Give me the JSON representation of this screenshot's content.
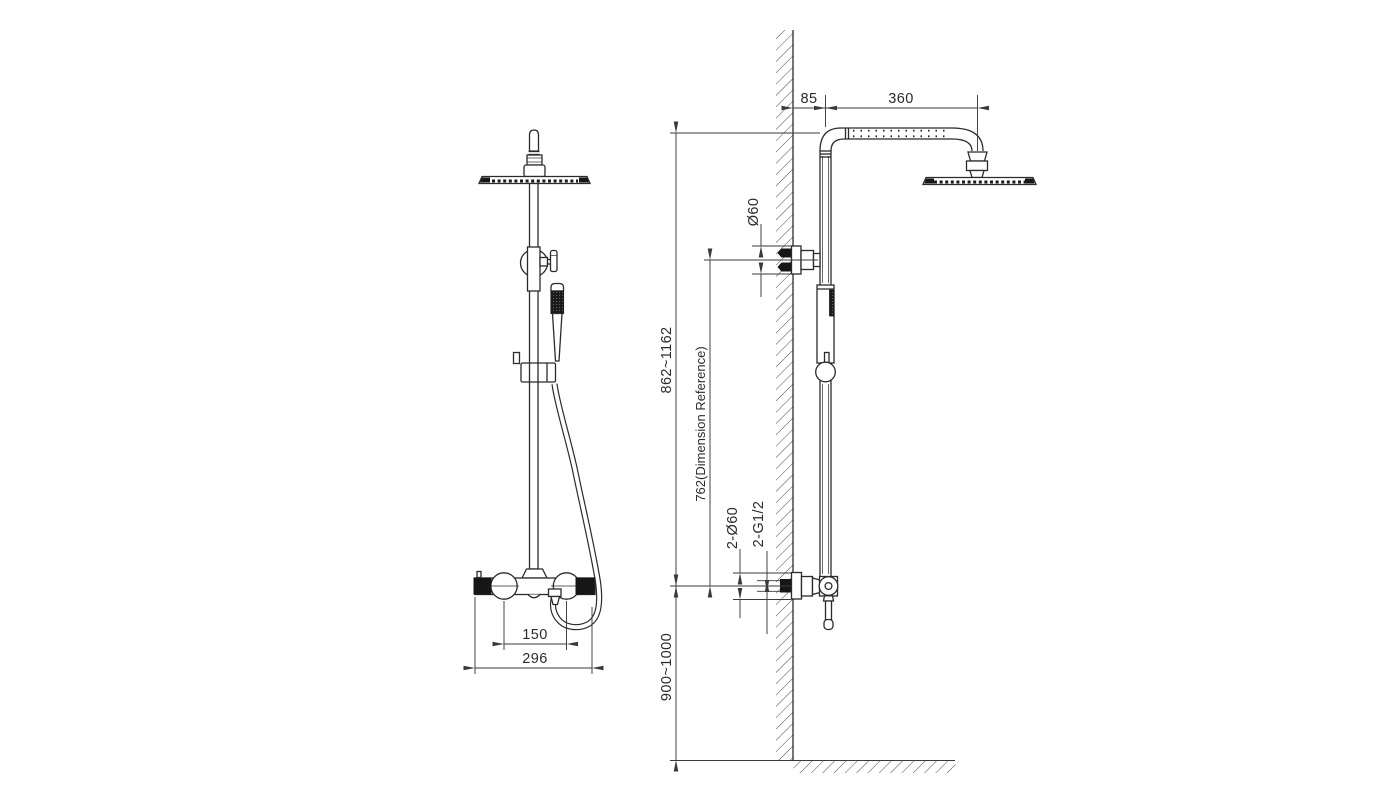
{
  "drawing": {
    "background": "#ffffff",
    "line_color": "#2b2b2b",
    "dimension_line_color": "#3a3a3a"
  },
  "dimensions": {
    "wall_offset": "85",
    "arm_length": "360",
    "bracket_diameter": "Ø60",
    "riser_height_range": "862~1162",
    "dimension_reference": "762(Dimension Reference)",
    "flange_diameters": "2-Ø60",
    "inlet_thread": "2-G1/2",
    "valve_install_height": "900~1000",
    "inlet_center_distance": "150",
    "valve_overall_width": "296"
  }
}
